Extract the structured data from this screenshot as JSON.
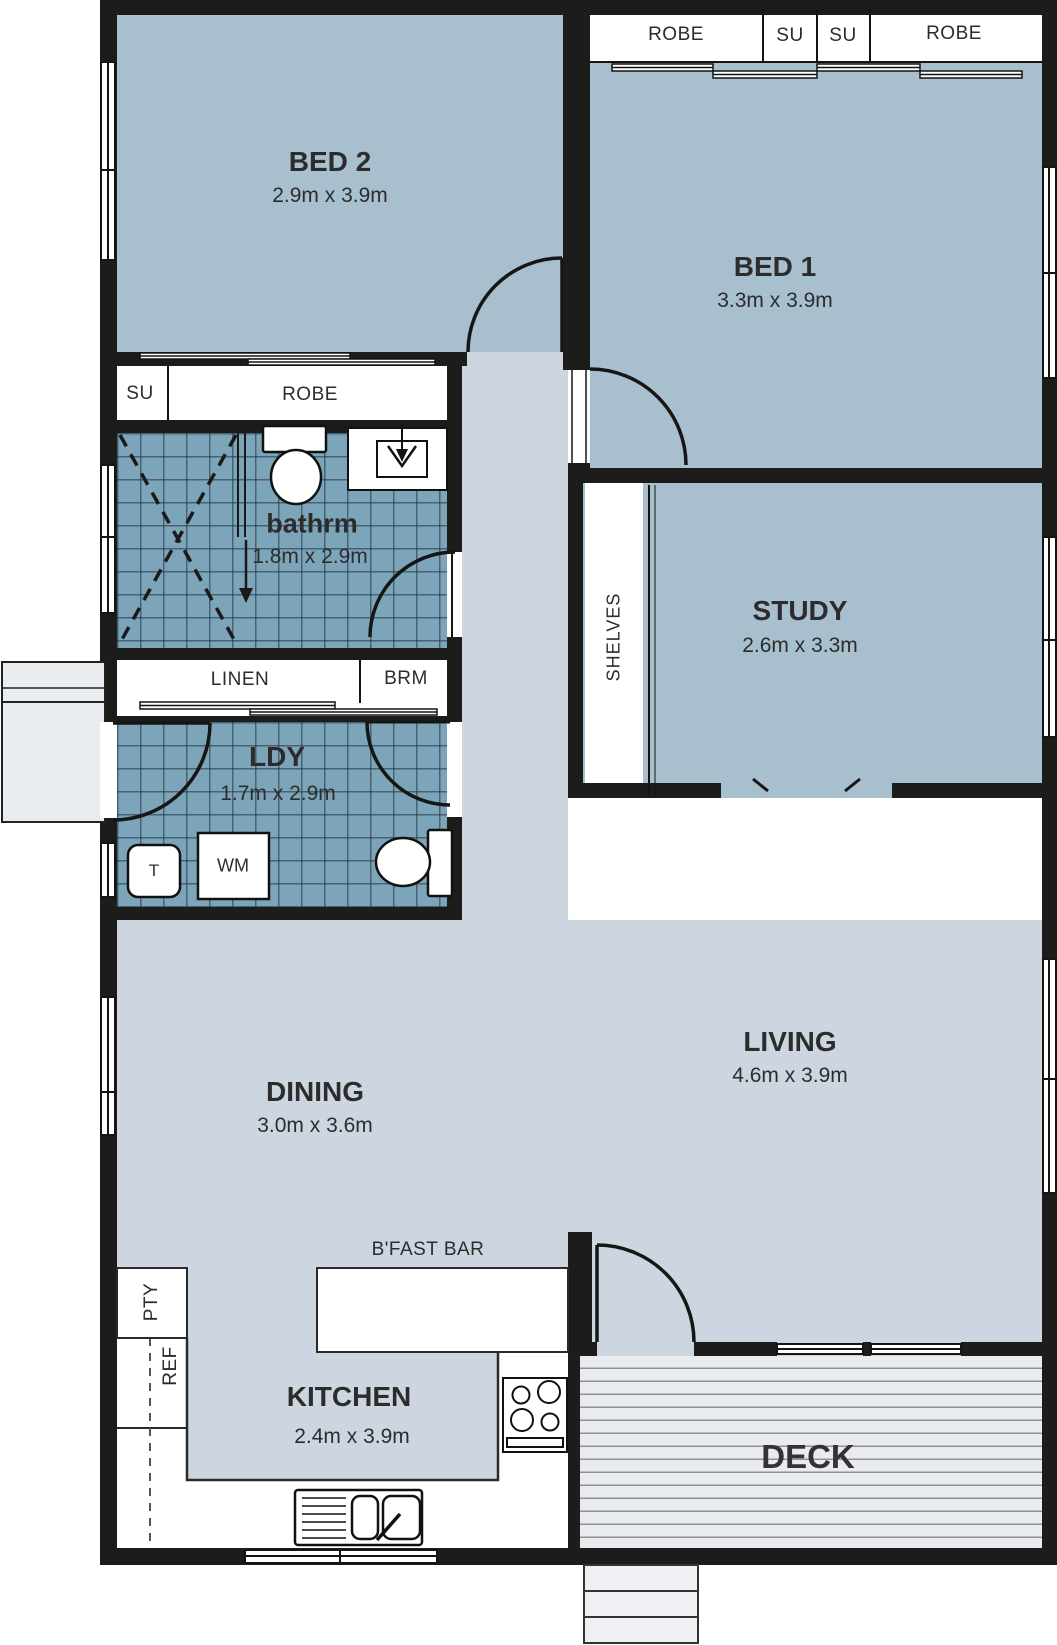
{
  "plan_title": "Residential floor plan",
  "colors": {
    "wall": "#1c1c1a",
    "room_floor": "#a8bfcd",
    "hall_floor": "#cdd6e0",
    "tile_floor": "#7da5ba",
    "deck_floor": "#e9ebee",
    "fixture": "#ffffff"
  },
  "rooms": {
    "bed2": {
      "name": "BED 2",
      "dims": "2.9m x 3.9m"
    },
    "bed1": {
      "name": "BED 1",
      "dims": "3.3m x 3.9m"
    },
    "study": {
      "name": "STUDY",
      "dims": "2.6m x 3.3m"
    },
    "bathroom": {
      "name": "bathrm",
      "dims": "1.8m x 2.9m"
    },
    "laundry": {
      "name": "LDY",
      "dims": "1.7m x 2.9m"
    },
    "dining": {
      "name": "DINING",
      "dims": "3.0m x 3.6m"
    },
    "living": {
      "name": "LIVING",
      "dims": "4.6m x 3.9m"
    },
    "kitchen": {
      "name": "KITCHEN",
      "dims": "2.4m x 3.9m"
    },
    "deck": {
      "name": "DECK"
    }
  },
  "fixtures": {
    "robe": "ROBE",
    "su": "SU",
    "linen": "LINEN",
    "brm": "BRM",
    "shelves": "SHELVES",
    "pantry": "PTY",
    "fridge": "REF",
    "washing_machine": "WM",
    "tub": "T",
    "bfast_bar": "B'FAST BAR"
  }
}
